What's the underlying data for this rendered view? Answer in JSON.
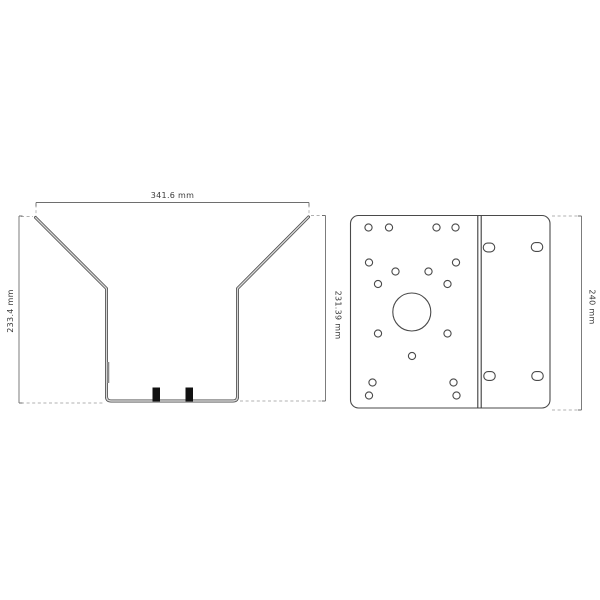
{
  "page": {
    "background": "#ffffff",
    "kind": "technical-drawing"
  },
  "drawing": {
    "funnel_view": {
      "width_label": "341.6 mm",
      "left_height_label": "233.4 mm",
      "right_height_label": "231.39 mm",
      "tab_count": 2
    },
    "plate_view": {
      "height_label": "240 mm",
      "small_hole_count": 17,
      "slot_count": 4,
      "large_hole_count": 1
    },
    "colors": {
      "line": "#4a4a4a",
      "metal_fill": "#d6d6d6",
      "dim_line": "#6e6e6e",
      "extension_dashed": "#b0b0b0",
      "text": "#3a3a3a",
      "tab_fill": "#111111"
    }
  }
}
